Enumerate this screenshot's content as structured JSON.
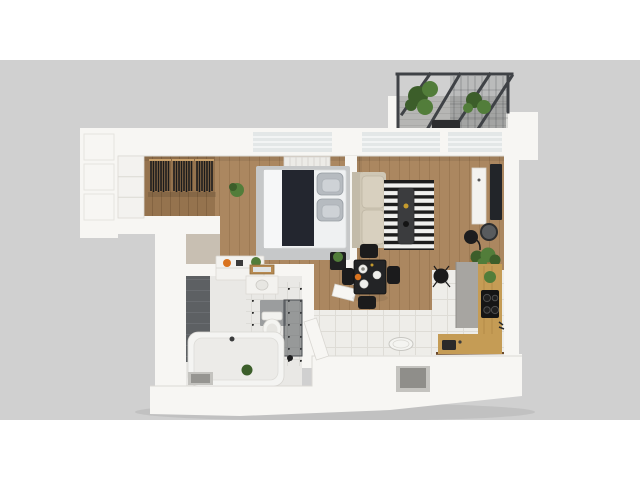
{
  "scene": {
    "title": "3D isometric floor plan render of a one-bedroom apartment",
    "background": "studio gray with white letterbox bands",
    "rooms": [
      {
        "name": "walk-in-closet",
        "floor": "wood",
        "furniture": [
          "white-wardrobe",
          "hanging-clothes-rails"
        ]
      },
      {
        "name": "bedroom",
        "floor": "wood",
        "furniture": [
          "double-bed",
          "dark-bed-runner",
          "gray-pillows",
          "area-rug",
          "nightstand-with-plant",
          "white-dresser",
          "radiator",
          "corner-plant"
        ]
      },
      {
        "name": "living-room",
        "floor": "wood",
        "furniture": [
          "beige-sofa",
          "black-white-striped-rug",
          "dark-coffee-table",
          "tv",
          "tv-console",
          "floor-lamp",
          "round-wall-mirror",
          "planter-box"
        ]
      },
      {
        "name": "dining-area",
        "floor": "wood",
        "furniture": [
          "black-dining-table",
          "four-black-chairs",
          "white-plates",
          "orange-bowl"
        ]
      },
      {
        "name": "kitchen",
        "floor": "white-tile",
        "furniture": [
          "l-shaped-oak-counter",
          "black-cooktop",
          "sink",
          "bar-stool",
          "counter-plant"
        ]
      },
      {
        "name": "bathroom",
        "floor": "dotted-tile",
        "furniture": [
          "bathtub",
          "toilet",
          "washbasin",
          "wood-framed-mirror",
          "shower-screen",
          "bath-mat",
          "floor-plant",
          "open-door"
        ]
      },
      {
        "name": "hallway",
        "floor": "white",
        "furniture": [
          "round-plate",
          "wall-niche"
        ]
      },
      {
        "name": "balcony",
        "floor": "gray-decking",
        "furniture": [
          "dark-pergola-frame",
          "hanging-plants",
          "grill",
          "white-planter-wall"
        ]
      }
    ]
  },
  "palette": {
    "page": "#ffffff",
    "bg": "#d0d0d0",
    "wall": "#f7f6f3",
    "wall_edge": "#dbd9d4",
    "tan_wall": "#c8bfb2",
    "wood": "#ab8760",
    "wood_line": "#97744e",
    "wood_closet": "#95734e",
    "wood_closet_line": "#7e5e3c",
    "wood_dark": "#6b4a2c",
    "oak": "#c59c55",
    "tile": "#eeede9",
    "tile_line": "#dedcd6",
    "bath_floor": "#e9e8e5",
    "bath_wall": "#5d6063",
    "glass": "#e3e7e7",
    "balcony_floor": "#b6b6b4",
    "pergola": "#3f4246",
    "plant": "#527d3a",
    "plant_dark": "#3c5e2a",
    "sofa": "#cfc7b5",
    "sofa_dark": "#c3bba9",
    "rug_gray": "#c6c8c9",
    "bed_dark": "#23262f",
    "pillow": "#b6bbc0",
    "stripe_black": "#1d1d1d",
    "stripe_white": "#f0f0ee",
    "ink": "#1b1b1c",
    "accent_orange": "#d9731f",
    "white_furn": "#f3f2ef",
    "gray_wall": "#a7a5a1"
  }
}
